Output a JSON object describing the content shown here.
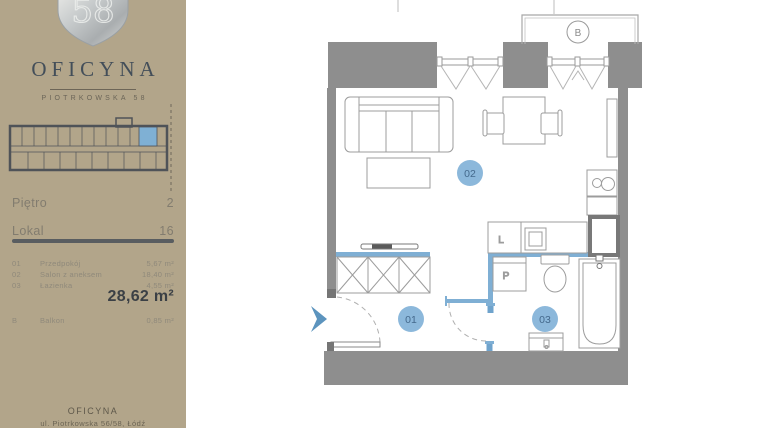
{
  "brand": {
    "logo_number": "58",
    "name": "OFICYNA",
    "subtitle": "PIOTRKOWSKA 58"
  },
  "sidebar": {
    "floor": {
      "label": "Piętro",
      "value": "2"
    },
    "unit": {
      "label": "Lokal",
      "value": "16"
    },
    "rooms": [
      {
        "no": "01",
        "name": "Przedpokój",
        "area": "5,67 m²"
      },
      {
        "no": "02",
        "name": "Salon z aneksem",
        "area": "18,40 m²"
      },
      {
        "no": "03",
        "name": "Łazienka",
        "area": "4,55 m²"
      }
    ],
    "total_area": "28,62 m²",
    "balcony_row": {
      "no": "B",
      "name": "Balkon",
      "area": "0,85 m²"
    },
    "footer": {
      "line1": "OFICYNA",
      "line2": "ul. Piotrkowska 56/58, Łódź"
    }
  },
  "plan": {
    "labels": {
      "room01": "01",
      "room02": "02",
      "room03": "03",
      "balcony": "B",
      "fridge": "L",
      "washer": "P"
    }
  },
  "colors": {
    "sidebar_bg": "#B2A58A",
    "accent_blue": "#7FAFD4",
    "label_circle_blue": "#8CB8DB",
    "wall_gray": "#8E8E8E",
    "title_dark": "#434E59",
    "total_dark": "#3B4045"
  }
}
